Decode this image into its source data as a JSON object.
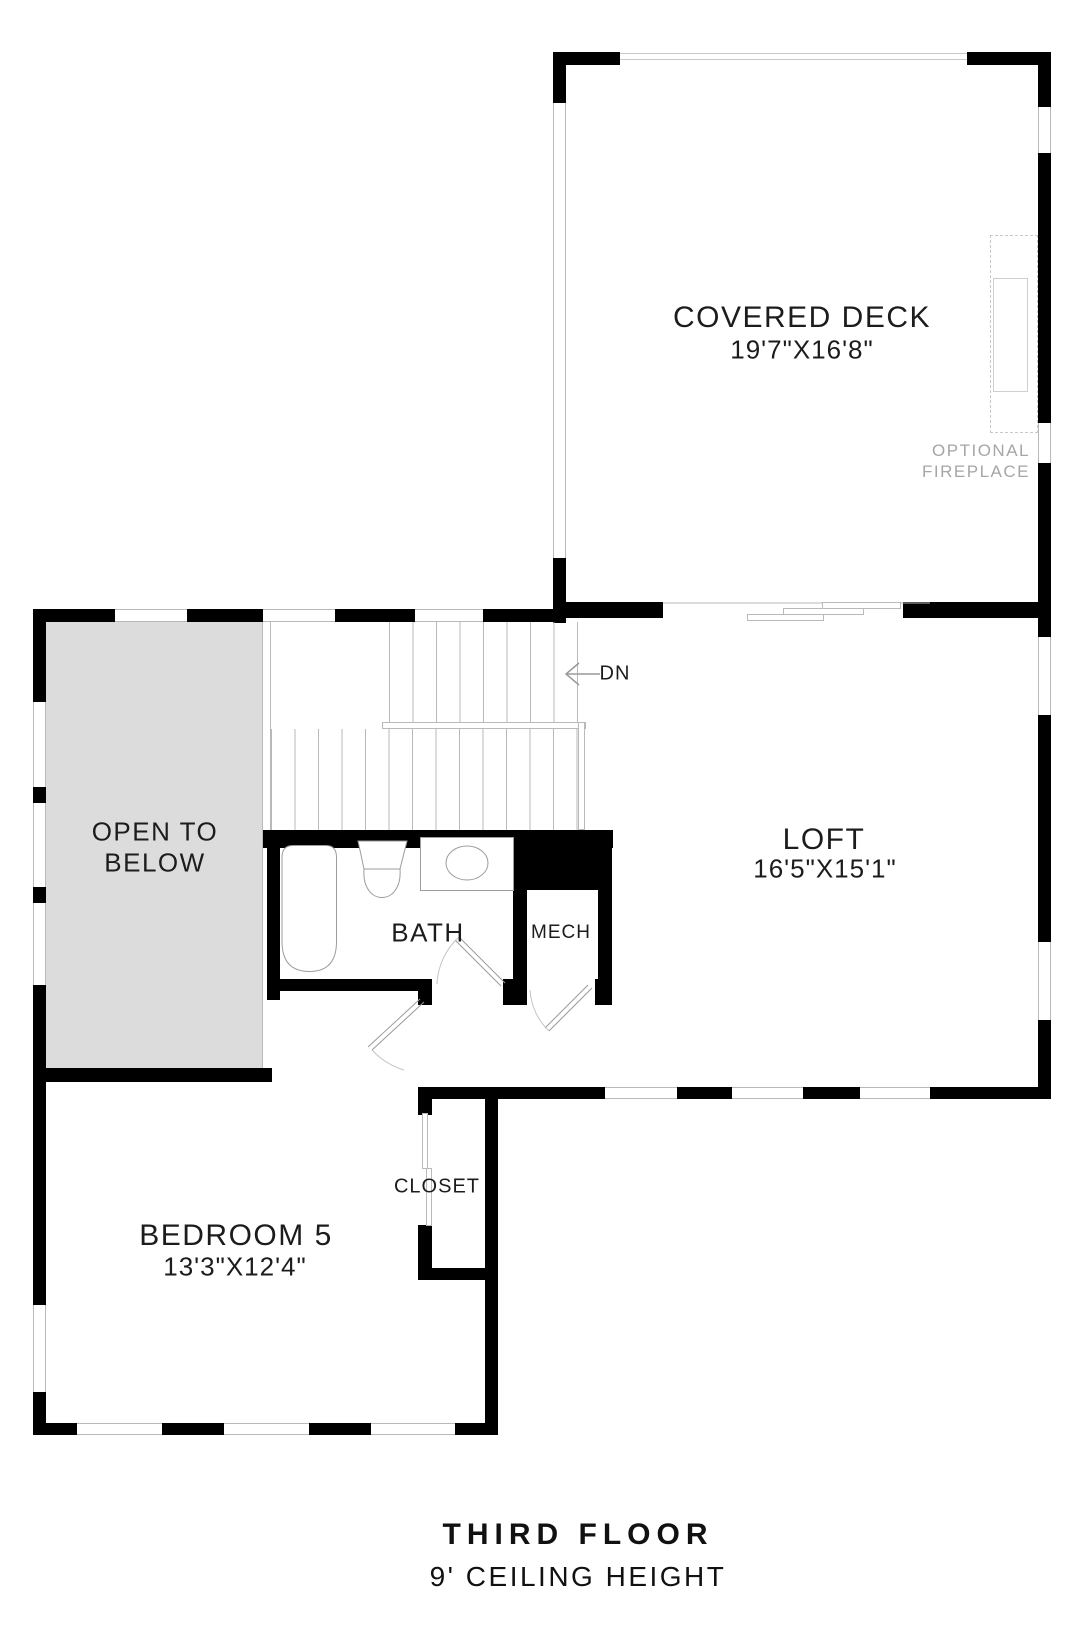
{
  "colors": {
    "wall": "#000000",
    "line_gray": "#b9b9b9",
    "open_to_below_fill": "#dcdcdd",
    "muted_text": "#a6a6a6",
    "label_ink": "#1c1c1c"
  },
  "rooms": {
    "covered_deck": {
      "name": "COVERED DECK",
      "dims": "19'7\"X16'8\""
    },
    "loft": {
      "name": "LOFT",
      "dims": "16'5\"X15'1\""
    },
    "bath": {
      "name": "BATH"
    },
    "mech": {
      "name": "MECH"
    },
    "bedroom5": {
      "name": "BEDROOM 5",
      "dims": "13'3\"X12'4\""
    },
    "closet": {
      "name": "CLOSET"
    },
    "open_to_below": {
      "line1": "OPEN TO",
      "line2": "BELOW"
    }
  },
  "annotations": {
    "stair_direction": "DN",
    "optional_fireplace_line1": "OPTIONAL",
    "optional_fireplace_line2": "FIREPLACE"
  },
  "footer": {
    "title": "THIRD FLOOR",
    "subtitle": "9' CEILING HEIGHT"
  }
}
